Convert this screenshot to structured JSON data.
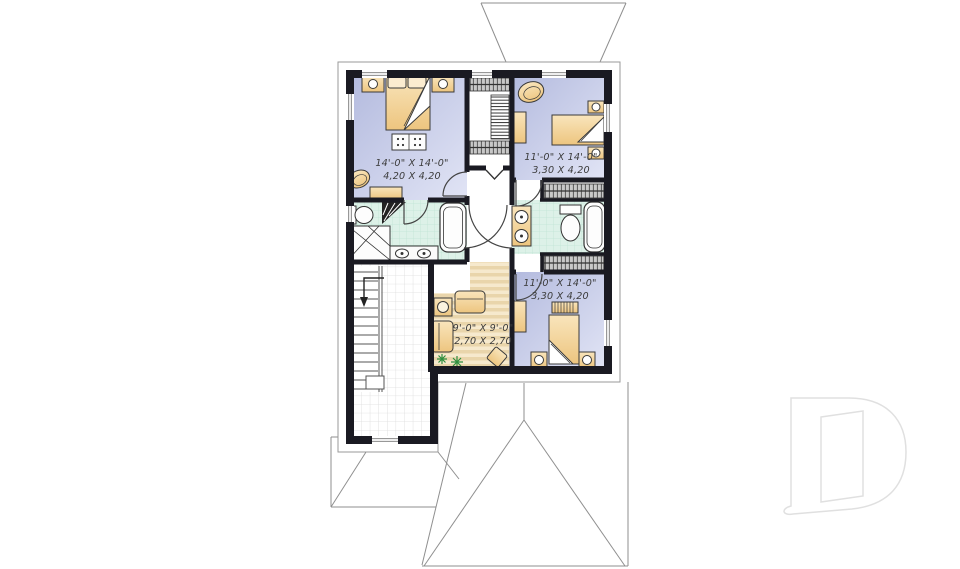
{
  "plan": {
    "type": "second-floor-plan",
    "rooms": [
      {
        "id": "master-bedroom",
        "imperial": "14'-0\" X 14'-0\"",
        "metric": "4,20 X 4,20"
      },
      {
        "id": "bedroom-2",
        "imperial": "11'-0\" X 14'-0\"",
        "metric": "3,30 X 4,20"
      },
      {
        "id": "bedroom-3",
        "imperial": "11'-0\" X 14'-0\"",
        "metric": "3,30 X 4,20"
      },
      {
        "id": "sitting-area",
        "imperial": "9'-0\" X 9'-0\"",
        "metric": "2,70 X 2,70"
      }
    ],
    "symbols": {
      "stair_arrow": "down-arrow",
      "closet_hatch": "hanging-rod",
      "watermark": "drummond-d-logo"
    },
    "colors": {
      "wall": "#1a1a22",
      "bedroom_floor": "#c3c8e6",
      "bathroom_floor": "#ddf1e8",
      "sitting_floor": "#f0dfbd",
      "furniture": "#f2cd92",
      "plant": "#2f8f3f",
      "roofline": "#8f8f8f",
      "watermark": "#e2e2e2"
    }
  }
}
